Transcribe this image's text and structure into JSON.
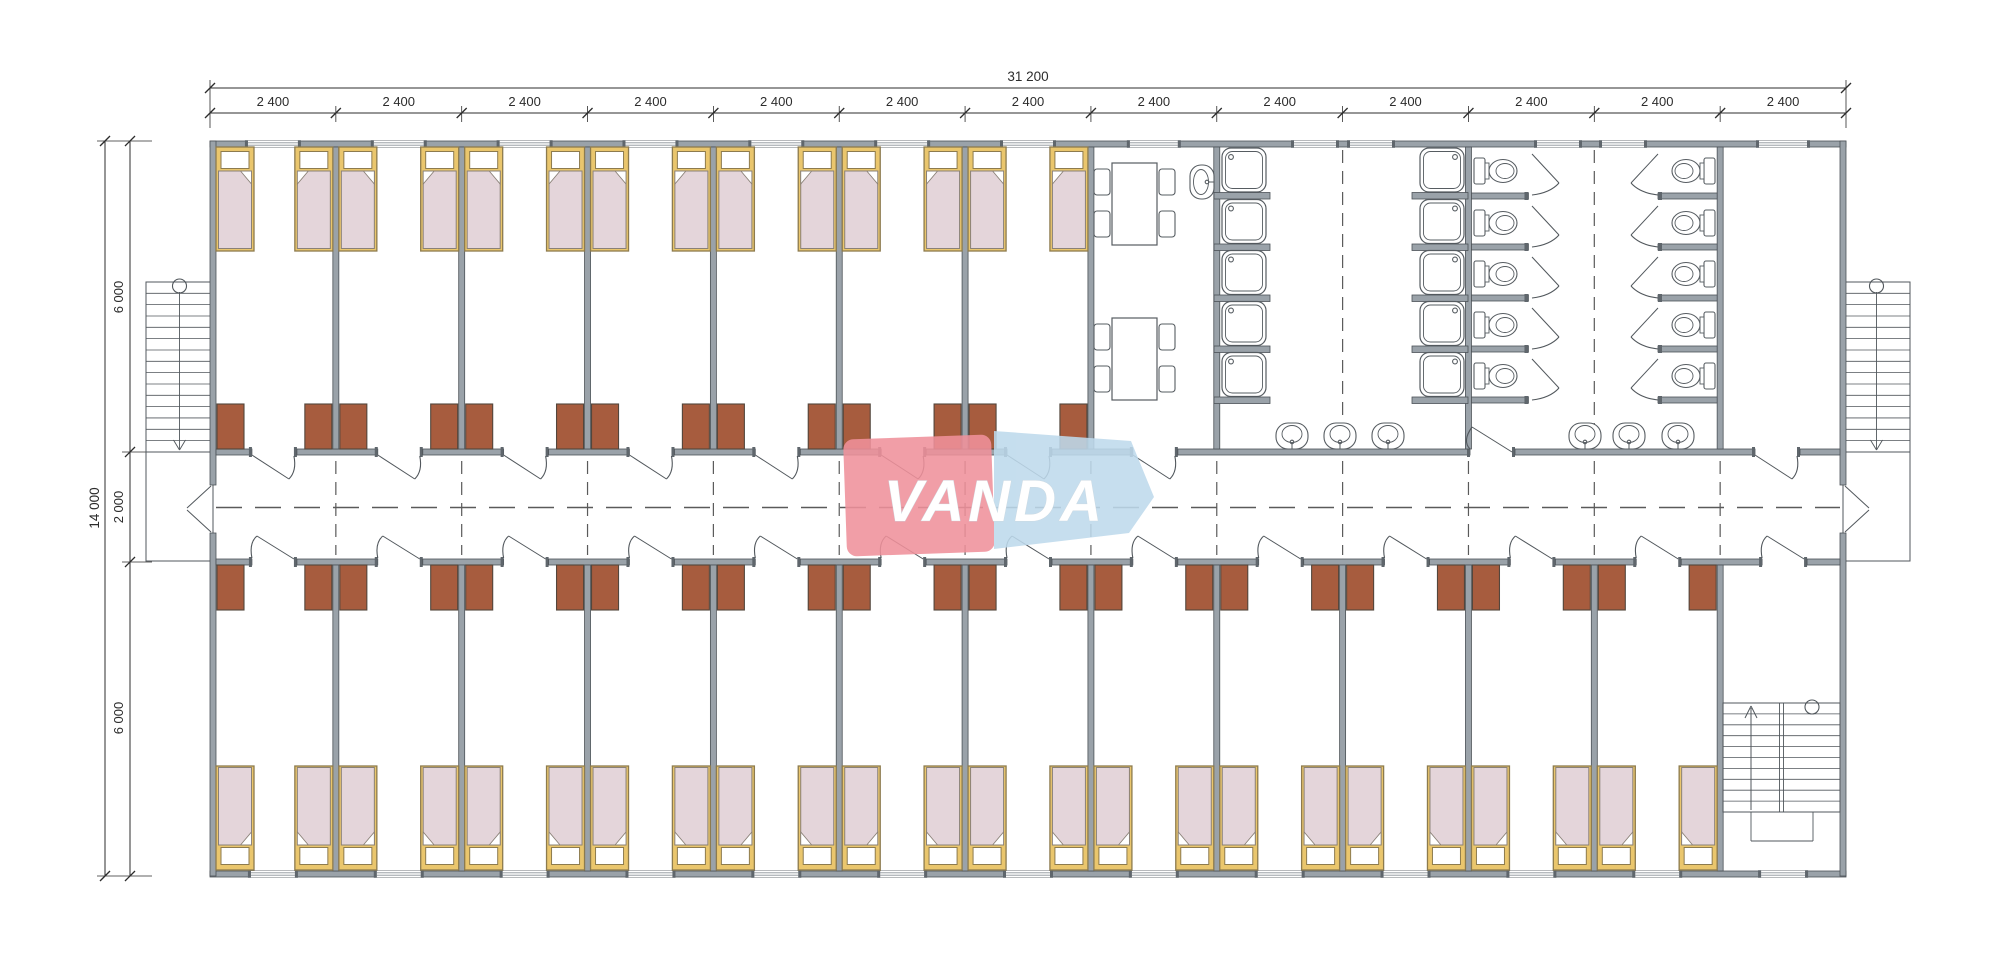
{
  "title": "VANDA modular dormitory floor plan",
  "logo": {
    "text": "VANDA",
    "red": "#f0919b",
    "blue": "#bedaec",
    "text_color": "#ffffff"
  },
  "dimensions": {
    "top": {
      "total": "31 200",
      "modules": [
        "2 400",
        "2 400",
        "2 400",
        "2 400",
        "2 400",
        "2 400",
        "2 400",
        "2 400",
        "2 400",
        "2 400",
        "2 400",
        "2 400",
        "2 400"
      ]
    },
    "left": {
      "total": "14 000",
      "segments": [
        "6 000",
        "2 000",
        "6 000"
      ]
    }
  },
  "counts": {
    "modules": 13,
    "bedrooms_top": 7,
    "bedrooms_bottom": 12,
    "beds": 38,
    "stools": 38,
    "dining_tables": 2,
    "chairs_per_table": 4,
    "shower_trays": 10,
    "toilets": 10,
    "wash_basins": 6,
    "wall_sink": 1,
    "exterior_stairs": 2,
    "interior_stairs": 1
  },
  "colors": {
    "wall_fill": "#9aa2a9",
    "wall_stroke": "#4c5257",
    "cap": "#5f666c",
    "line": "#51575c",
    "dash": "#5a5a5a",
    "dim": "#2c2c2c",
    "bed_frame": "#eac66d",
    "bed_border": "#8d7b4e",
    "mattress": "#e4d5da",
    "mattress_border": "#8a8177",
    "pillow": "#ffffff",
    "stool": "#a75c3e",
    "stool_border": "#53463c",
    "fixture": "#565c61"
  }
}
